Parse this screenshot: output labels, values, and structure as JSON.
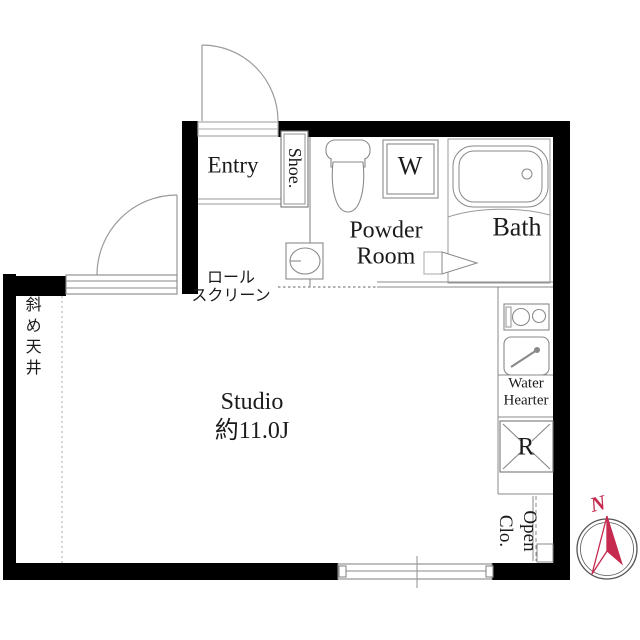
{
  "rooms": {
    "entry": {
      "label": "Entry"
    },
    "shoe_box": {
      "label": "Shoe."
    },
    "washing_machine": {
      "label": "W"
    },
    "powder_room": {
      "line1": "Powder",
      "line2": "Room"
    },
    "bath": {
      "label": "Bath"
    },
    "studio": {
      "name": "Studio",
      "area": "約11.0J"
    },
    "water_heater": {
      "line1": "Water",
      "line2": "Hearter"
    },
    "refrigerator": {
      "label": "R"
    },
    "open_closet": {
      "line1": "Open",
      "line2": "Clo."
    }
  },
  "annotations": {
    "roll_screen": {
      "line1": "ロール",
      "line2": "スクリーン"
    },
    "slanted_ceiling": {
      "label": "斜め天井"
    }
  },
  "compass": {
    "north": "N",
    "needle_color": "#c62a4f"
  },
  "palette": {
    "wall": "#000000",
    "fixture_line": "#8a8a8a",
    "outline": "#999999",
    "text": "#1b1b1b",
    "background": "#ffffff"
  }
}
